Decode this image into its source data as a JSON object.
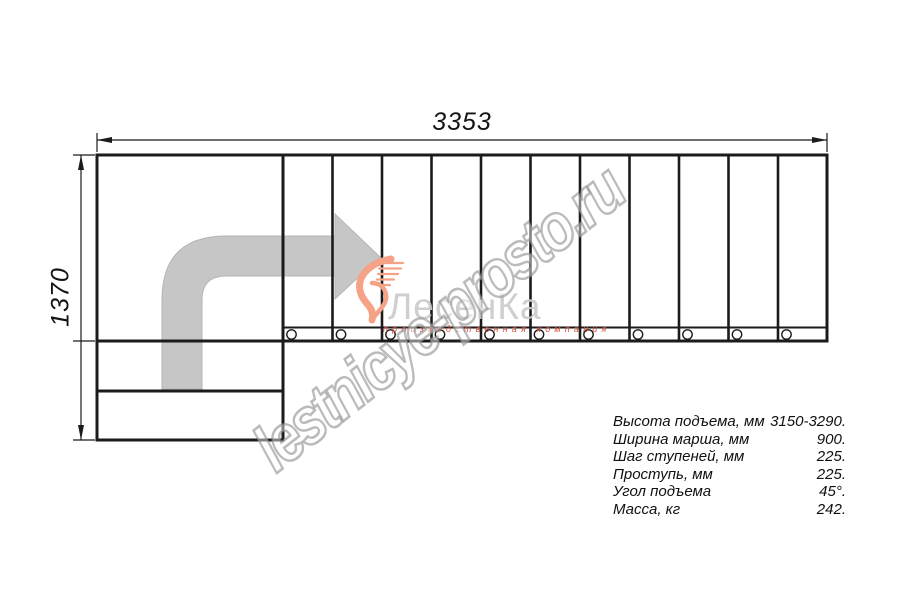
{
  "drawing": {
    "top_dimension_label": "3353",
    "left_dimension_label": "1370",
    "tread_count": 11,
    "colors": {
      "line": "#1b1b1b",
      "direction_arrow_fill": "#c6c6c6",
      "logo_swoosh": "#f5a287",
      "logo_text": "#cbcbcb",
      "logo_tagline": "#d84b33",
      "watermark_outline": "#929292"
    }
  },
  "logo": {
    "name": "ЛесенКа",
    "tagline": "производственная компания"
  },
  "watermark": {
    "text": "lestnicye-prosto.ru"
  },
  "specs": {
    "rows": [
      {
        "label": "Высота подъема, мм",
        "value": "3150-3290."
      },
      {
        "label": "Ширина марша, мм",
        "value": "900."
      },
      {
        "label": "Шаг ступеней, мм",
        "value": "225."
      },
      {
        "label": "Проступь, мм",
        "value": "225."
      },
      {
        "label": "Угол подъема",
        "value": "45°."
      },
      {
        "label": "Масса, кг",
        "value": "242."
      }
    ]
  }
}
